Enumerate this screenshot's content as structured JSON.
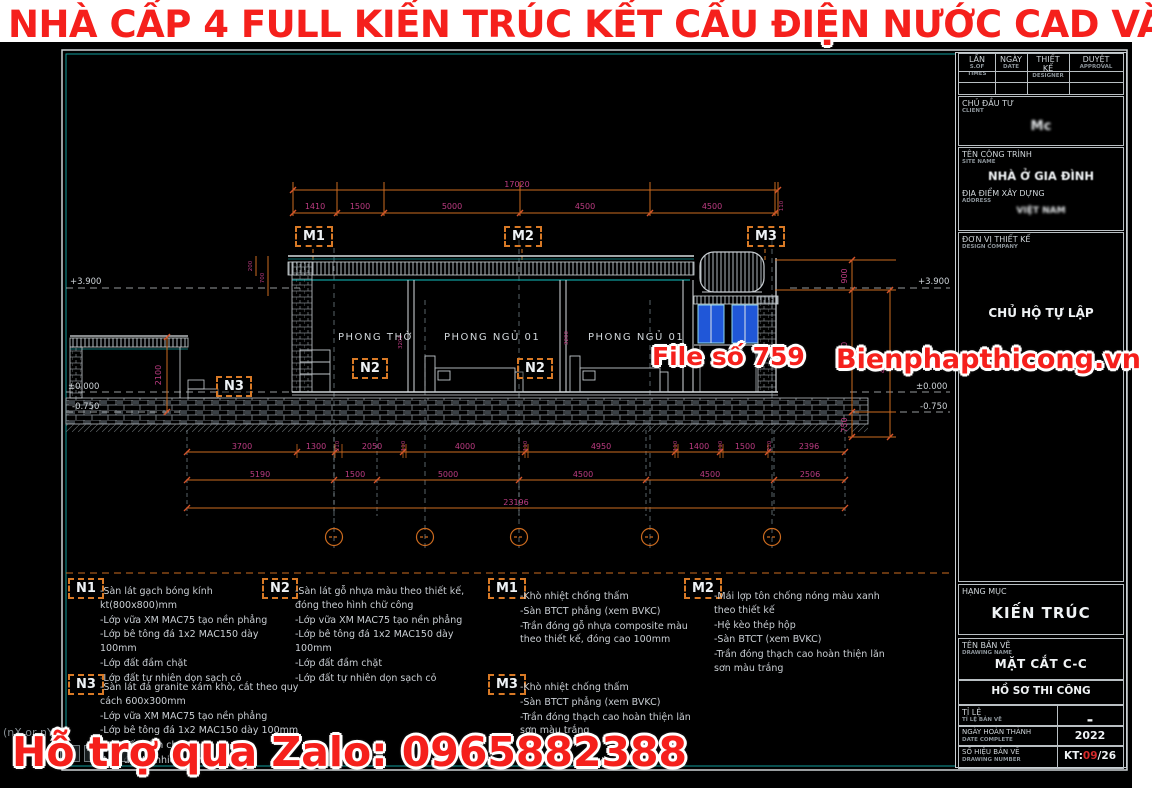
{
  "promo": {
    "title": "NHÀ CẤP 4 FULL KIẾN TRÚC KẾT CẤU ĐIỆN NƯỚC CAD VÀ PDF",
    "file_no": "File số 759",
    "site": "Bienphapthicong.vn",
    "zalo": "Hỗ trợ qua Zalo: 0965882388",
    "overlay": "(nX or nY)",
    "overlay_icon": "❐"
  },
  "colors": {
    "promo_red": "#f5201c",
    "dim_orange": "#cc6b1f",
    "dim_text": "#bd3c82",
    "teal": "#0f9b9b",
    "window_blue": "#2057d8"
  },
  "tb": {
    "rev": {
      "c0": {
        "vn": "LẦN",
        "en": "S.OF TIMES"
      },
      "c1": {
        "vn": "NGÀY",
        "en": "DATE"
      },
      "c2": {
        "vn": "THIẾT KẾ",
        "en": "DESIGNER"
      },
      "c3": {
        "vn": "DUYỆT",
        "en": "APPROVAL"
      }
    },
    "client": {
      "label": "CHỦ ĐẦU TƯ",
      "sub": "CLIENT",
      "value": "Mc"
    },
    "project": {
      "label": "TÊN CÔNG TRÌNH",
      "sub": "SITE NAME",
      "value": "NHÀ Ở GIA ĐÌNH"
    },
    "address": {
      "label": "ĐỊA ĐIỂM XÂY DỰNG",
      "sub": "ADDRESS",
      "value": "VIỆT NAM"
    },
    "design": {
      "label": "ĐƠN VỊ THIẾT KẾ",
      "sub": "DESIGN COMPANY",
      "value": "CHỦ HỘ TỰ LẬP"
    },
    "category": {
      "label": "HẠNG MỤC",
      "value": "KIẾN TRÚC"
    },
    "drawing": {
      "label": "TÊN BẢN VẼ",
      "sub": "DRAWING NAME",
      "value": "MẶT CẮT C-C"
    },
    "stage": {
      "value": "HỒ SƠ THI CÔNG"
    },
    "scale": {
      "label": "TỈ LỆ",
      "sub": "TỈ LỆ BẢN VẼ",
      "value": "-"
    },
    "date": {
      "label": "NGÀY HOÀN THÀNH",
      "sub": "DATE COMPLETE",
      "value": "2022"
    },
    "number": {
      "label": "SỐ HIỆU BẢN VẼ",
      "sub": "DRAWING NUMBER",
      "prefix": "KT:",
      "mid": "09",
      "suffix": "/26"
    }
  },
  "sec": {
    "markers": {
      "m1": "M1",
      "m2": "M2",
      "m3": "M3",
      "n1": "N1",
      "n2": "N2",
      "n3": "N3"
    },
    "rooms": [
      "PHONG THỜ",
      "PHONG NGỦ 01",
      "PHONG NGỦ 01"
    ],
    "lvl": {
      "roof": "+3.900",
      "floor": "±0.000",
      "ground": "-0.750"
    },
    "top": {
      "total": "17020",
      "segs": [
        "1410",
        "1500",
        "5000",
        "4500",
        "4500",
        "110"
      ]
    },
    "b1": [
      "3700",
      "1300",
      "210",
      "2050",
      "110",
      "4000",
      "110",
      "4950",
      "110",
      "1400",
      "110",
      "1500",
      "210",
      "2396"
    ],
    "b2": [
      "5190",
      "1500",
      "5000",
      "4500",
      "4500",
      "2506"
    ],
    "btotal": "23196",
    "v": {
      "l2100": "2100",
      "l200": "200",
      "l700": "700",
      "r900": "900",
      "r3900": "3900",
      "r750": "750",
      "r4650": "4650",
      "w1": "3200",
      "w2": "3200"
    }
  },
  "notes": {
    "n1": [
      "-Sàn lát gạch bóng kính kt(800x800)mm",
      "-Lớp vữa XM MAC75 tạo nền phẳng",
      "-Lớp bê tông đá 1x2 MAC150 dày 100mm",
      "-Lớp đất đầm chặt",
      "-Lớp đất tự nhiên dọn sạch cỏ"
    ],
    "n2": [
      "-Sàn lát gỗ nhựa màu theo thiết kế, đóng theo hình chữ công",
      "-Lớp vữa XM MAC75 tạo nền phẳng",
      "-Lớp bê tông đá 1x2 MAC150 dày 100mm",
      "-Lớp đất đầm chặt",
      "-Lớp đất tự nhiên dọn sạch cỏ"
    ],
    "m1": [
      "-Khò nhiệt chống thấm",
      "-Sàn BTCT phẳng (xem BVKC)",
      "-Trần đóng gỗ nhựa composite màu theo thiết kế, đóng cao 100mm"
    ],
    "m2": [
      "-Mái lợp tôn chống nóng màu xanh theo thiết kế",
      "-Hệ kèo thép hộp",
      "-Sàn BTCT (xem BVKC)",
      "-Trần đóng thạch cao hoàn thiện lăn sơn màu trắng"
    ],
    "n3": [
      "-Sàn lát đá granite xám khò, cắt theo quy cách 600x300mm",
      "-Lớp vữa XM MAC75 tạo nền phẳng",
      "-Lớp bê tông đá 1x2 MAC150 dày 100mm",
      "-Lớp đất đầm chặt",
      "-Lớp đất tự nhiên dọn sạch cỏ"
    ],
    "m3": [
      "-Khò nhiệt chống thấm",
      "-Sàn BTCT phẳng (xem BVKC)",
      "-Trần đóng thạch cao hoàn thiện lăn sơn màu trắng"
    ]
  }
}
